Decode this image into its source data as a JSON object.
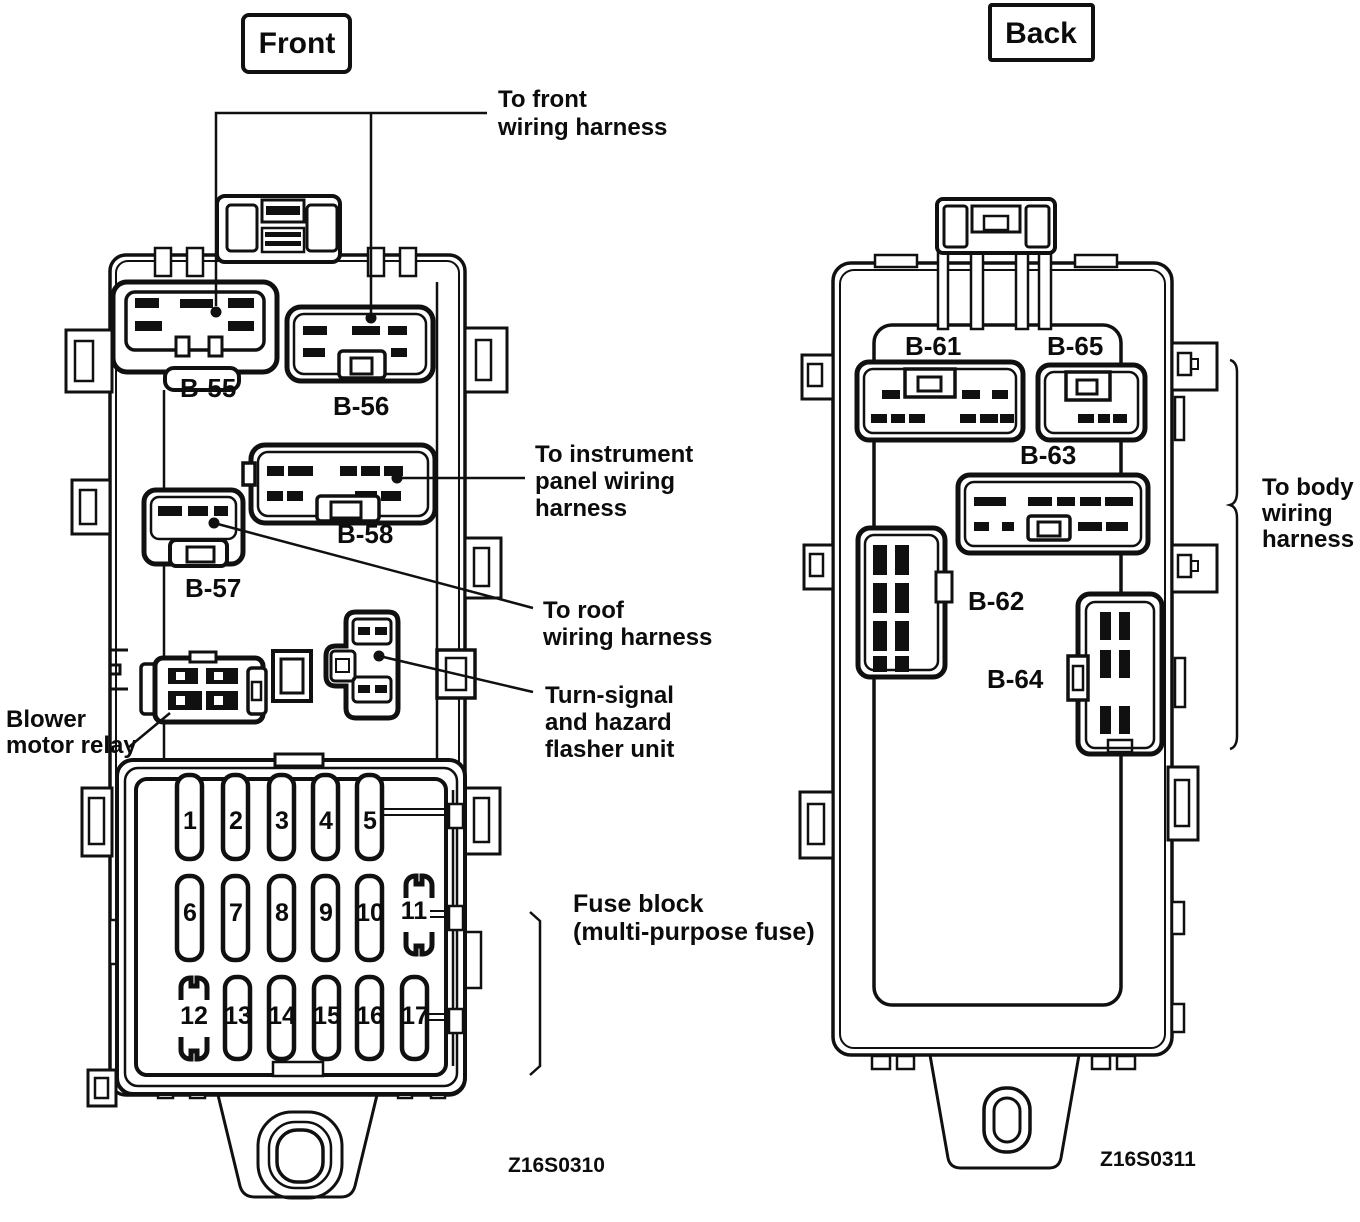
{
  "colors": {
    "ink": "#101010",
    "paper": "#ffffff"
  },
  "front": {
    "view_label": "Front",
    "figure_code": "Z16S0310",
    "connectors": {
      "b55": "B-55",
      "b56": "B-56",
      "b57": "B-57",
      "b58": "B-58"
    },
    "component_labels": {
      "blower": [
        "Blower",
        "motor relay"
      ],
      "turn_signal": [
        "Turn-signal",
        "and hazard",
        "flasher unit"
      ]
    },
    "annotations": {
      "to_front": [
        "To front",
        "wiring harness"
      ],
      "to_instrument": [
        "To instrument",
        "panel wiring",
        "harness"
      ],
      "to_roof": [
        "To roof",
        "wiring harness"
      ]
    },
    "fuse_block": {
      "caption": [
        "Fuse block",
        "(multi-purpose fuse)"
      ],
      "fuses": [
        "1",
        "2",
        "3",
        "4",
        "5",
        "6",
        "7",
        "8",
        "9",
        "10",
        "11",
        "12",
        "13",
        "14",
        "15",
        "16",
        "17"
      ]
    }
  },
  "back": {
    "view_label": "Back",
    "figure_code": "Z16S0311",
    "connectors": {
      "b61": "B-61",
      "b62": "B-62",
      "b63": "B-63",
      "b64": "B-64",
      "b65": "B-65"
    },
    "annotations": {
      "to_body": [
        "To body",
        "wiring",
        "harness"
      ]
    }
  }
}
